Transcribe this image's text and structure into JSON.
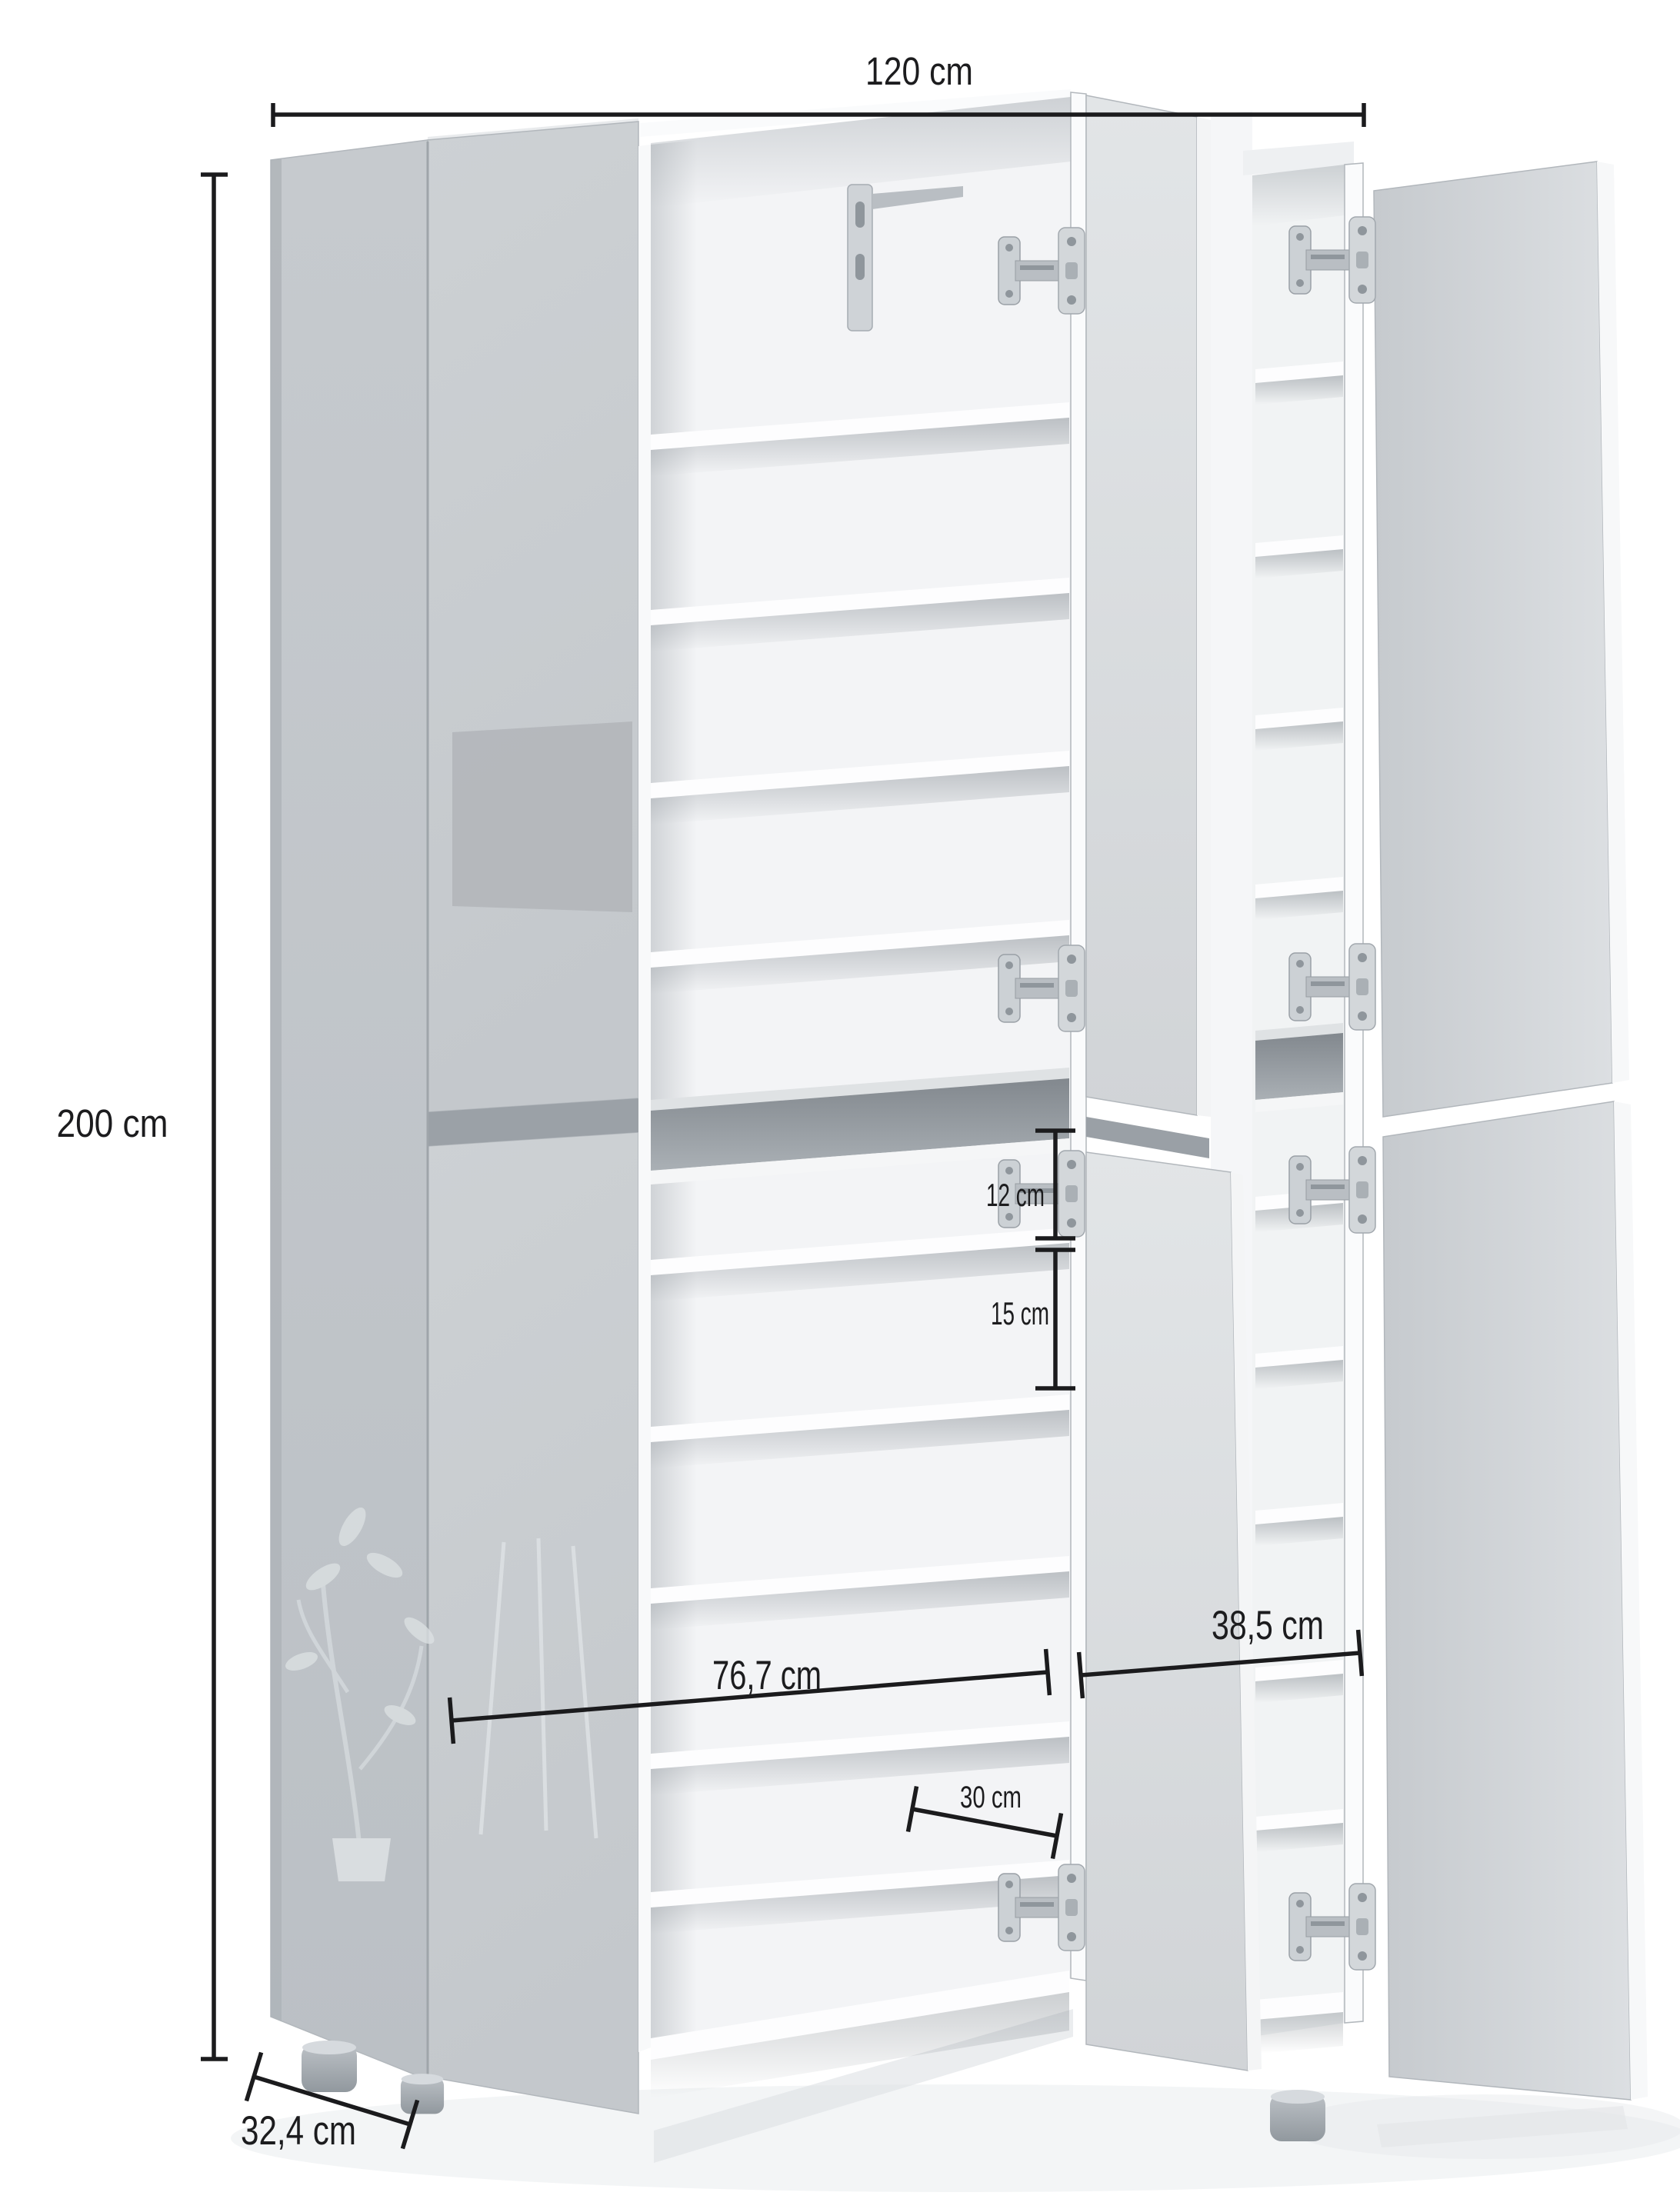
{
  "page": {
    "type": "product-dimension-diagram",
    "subject": "Tall white shoe cabinet with six doors, three doors open showing interior shelves, annotated with measurements",
    "background": "#ffffff"
  },
  "measurements": [
    {
      "id": "width-total",
      "label": "120 cm",
      "value": 120,
      "unit": "cm",
      "orientation": "horizontal-top"
    },
    {
      "id": "height-total",
      "label": "200 cm",
      "value": 200,
      "unit": "cm",
      "orientation": "vertical-left"
    },
    {
      "id": "depth-total",
      "label": "32,4 cm",
      "value": 32.4,
      "unit": "cm",
      "orientation": "diagonal-bottom-left"
    },
    {
      "id": "inner-width-left",
      "label": "76,7 cm",
      "value": 76.7,
      "unit": "cm",
      "orientation": "diagonal-middle"
    },
    {
      "id": "inner-width-right",
      "label": "38,5 cm",
      "value": 38.5,
      "unit": "cm",
      "orientation": "diagonal-middle"
    },
    {
      "id": "shelf-depth",
      "label": "30 cm",
      "value": 30,
      "unit": "cm",
      "orientation": "diagonal-shelf"
    },
    {
      "id": "shelf-gap-top",
      "label": "12 cm",
      "value": 12,
      "unit": "cm",
      "orientation": "vertical-inner"
    },
    {
      "id": "shelf-gap-bottom",
      "label": "15 cm",
      "value": 15,
      "unit": "cm",
      "orientation": "vertical-inner"
    }
  ],
  "colors": {
    "dimension_ink": "#1b1b1d",
    "door_gray": "#c8ccd0",
    "open_door_gray": "#d5d8db",
    "interior_white": "#f3f4f6",
    "niche_gray": "#9aa0a6",
    "hinge_metal": "#c6cbd0"
  }
}
